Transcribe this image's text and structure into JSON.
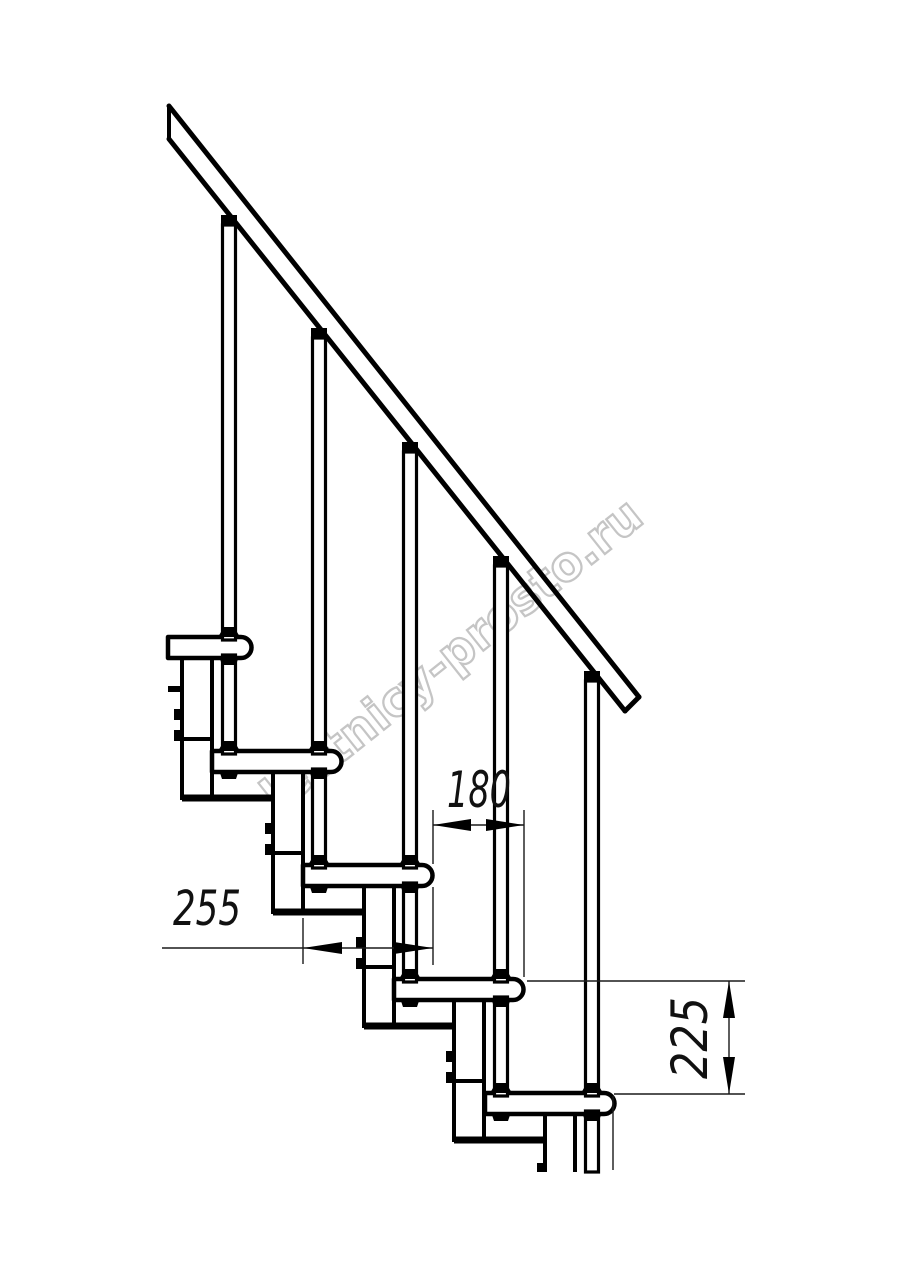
{
  "drawing": {
    "type": "staircase-side-view",
    "background": "#ffffff",
    "line_color": "#000000",
    "thin_line_color": "#1a1a1a",
    "treads_count": 5,
    "balusters_count": 5
  },
  "watermark": {
    "text": "lestnicy-prosto.ru",
    "color": "#c5c5c5"
  },
  "dimensions": {
    "run": {
      "label": "180"
    },
    "tread_depth": {
      "label": "255"
    },
    "riser": {
      "label": "225"
    }
  }
}
